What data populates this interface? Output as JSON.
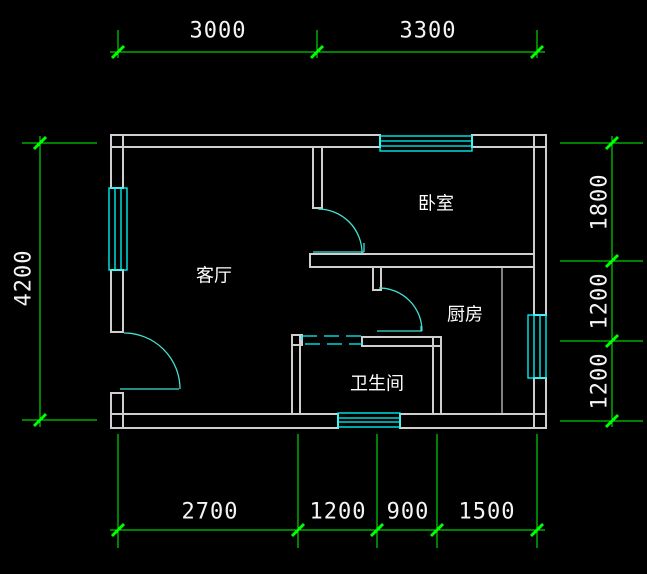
{
  "drawing": {
    "type": "floor-plan",
    "background": "#000000",
    "colors": {
      "wall": "#cfcfcf",
      "dimension_line": "#00ff00",
      "window_door": "#00ffff",
      "text": "#ffffff"
    },
    "rooms": [
      {
        "name": "living-room",
        "label": "客厅"
      },
      {
        "name": "bedroom",
        "label": "卧室"
      },
      {
        "name": "kitchen",
        "label": "厨房"
      },
      {
        "name": "bathroom",
        "label": "卫生间"
      }
    ],
    "dimensions": {
      "top": [
        "3000",
        "3300"
      ],
      "bottom": [
        "2700",
        "1200",
        "900",
        "1500"
      ],
      "left": [
        "4200"
      ],
      "right": [
        "1800",
        "1200",
        "1200"
      ]
    }
  }
}
